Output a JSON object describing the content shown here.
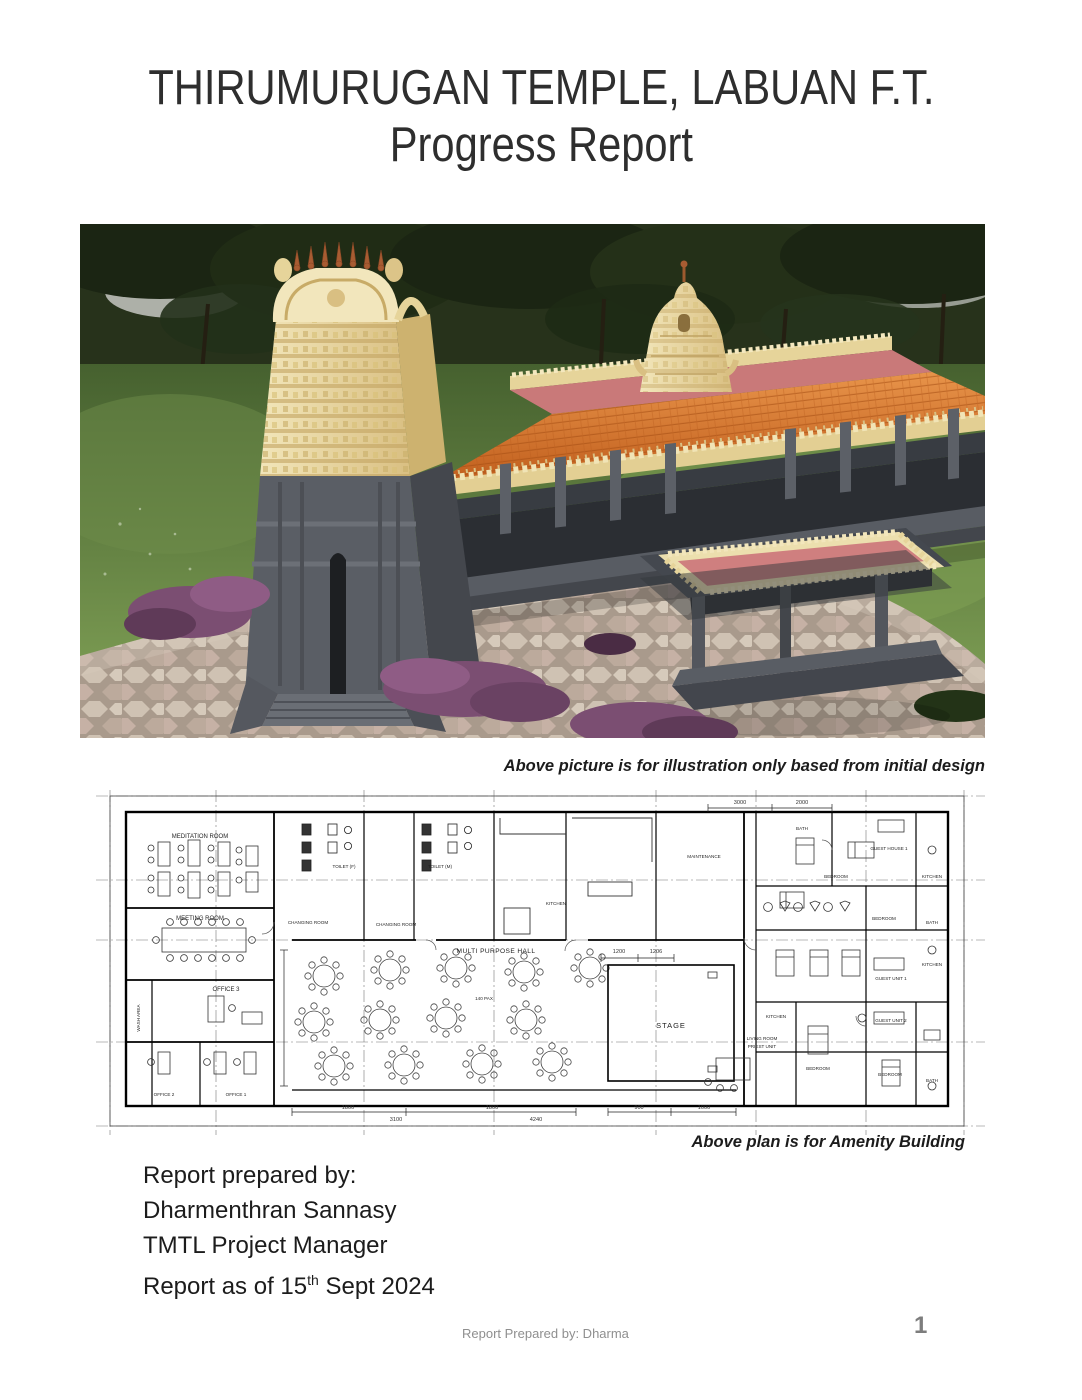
{
  "page": {
    "title_line1": "THIRUMURUGAN TEMPLE, LABUAN F.T.",
    "title_line2": "Progress Report",
    "footer_left": "Report Prepared by: Dharma",
    "page_number": "1"
  },
  "temple_illustration": {
    "caption": "Above picture is for illustration only based from initial design",
    "description": "3D architectural render of Thirumurugan Temple: cream gopuram tower with copper finials over a grey stone base and entry steps, long prayer hall with orange tiled roof, small golden vimana on a pink flat roof, grey open colonnade, detached grey mandapam pavilion with cream parapet, purple flowering shrubs, hexagonal pavers and lawn with trees",
    "colors": {
      "tree_canopy": "#1f2a15",
      "grass": "#5d7c42",
      "gopuram_cream": "#ecdfae",
      "finial_copper": "#a85c32",
      "roof_orange": "#d2691e",
      "flat_roof_pink": "#cf7f7f",
      "stone_grey": "#54575e",
      "pavers": "#c9bcae",
      "shrub_purple": "#7b4e72"
    }
  },
  "floor_plan": {
    "caption": "Above plan is for Amenity Building",
    "hall_capacity": "140 PAX",
    "rooms": [
      {
        "label": "MEDITATION ROOM"
      },
      {
        "label": "MEETING ROOM"
      },
      {
        "label": "WASH AREA"
      },
      {
        "label": "OFFICE 3"
      },
      {
        "label": "OFFICE 2"
      },
      {
        "label": "OFFICE 1"
      },
      {
        "label": "TOILET (F)"
      },
      {
        "label": "CHANGING ROOM"
      },
      {
        "label": "TOILET (M)"
      },
      {
        "label": "CHANGING ROOM"
      },
      {
        "label": "KITCHEN"
      },
      {
        "label": "MULTI PURPOSE HALL"
      },
      {
        "label": "140 PAX"
      },
      {
        "label": "STAGE"
      },
      {
        "label": "MAINTENANCE"
      },
      {
        "label": "BATH"
      },
      {
        "label": "BEDROOM"
      },
      {
        "label": "GUEST HOUSE 1"
      },
      {
        "label": "KITCHEN"
      },
      {
        "label": "BEDROOM"
      },
      {
        "label": "BATH"
      },
      {
        "label": "KITCHEN"
      },
      {
        "label": "GUEST UNIT 1"
      },
      {
        "label": "GUEST UNIT 2"
      },
      {
        "label": "LIVING ROOM"
      },
      {
        "label": "PRIEST UNIT"
      },
      {
        "label": "KITCHEN"
      },
      {
        "label": "BEDROOM"
      },
      {
        "label": "BEDROOM"
      },
      {
        "label": "BATH"
      }
    ],
    "dimensions": [
      {
        "value": "1800"
      },
      {
        "value": "1800"
      },
      {
        "value": "900"
      },
      {
        "value": "1000"
      },
      {
        "value": "3100"
      },
      {
        "value": "4240"
      },
      {
        "value": "1200"
      },
      {
        "value": "1206"
      },
      {
        "value": "3000"
      },
      {
        "value": "2000"
      }
    ]
  },
  "prepared_by": {
    "line1": "Report prepared by:",
    "line2": "Dharmenthran Sannasy",
    "line3": "TMTL Project Manager",
    "line4_prefix": "Report as of 15",
    "line4_sup": "th",
    "line4_suffix": " Sept 2024"
  }
}
